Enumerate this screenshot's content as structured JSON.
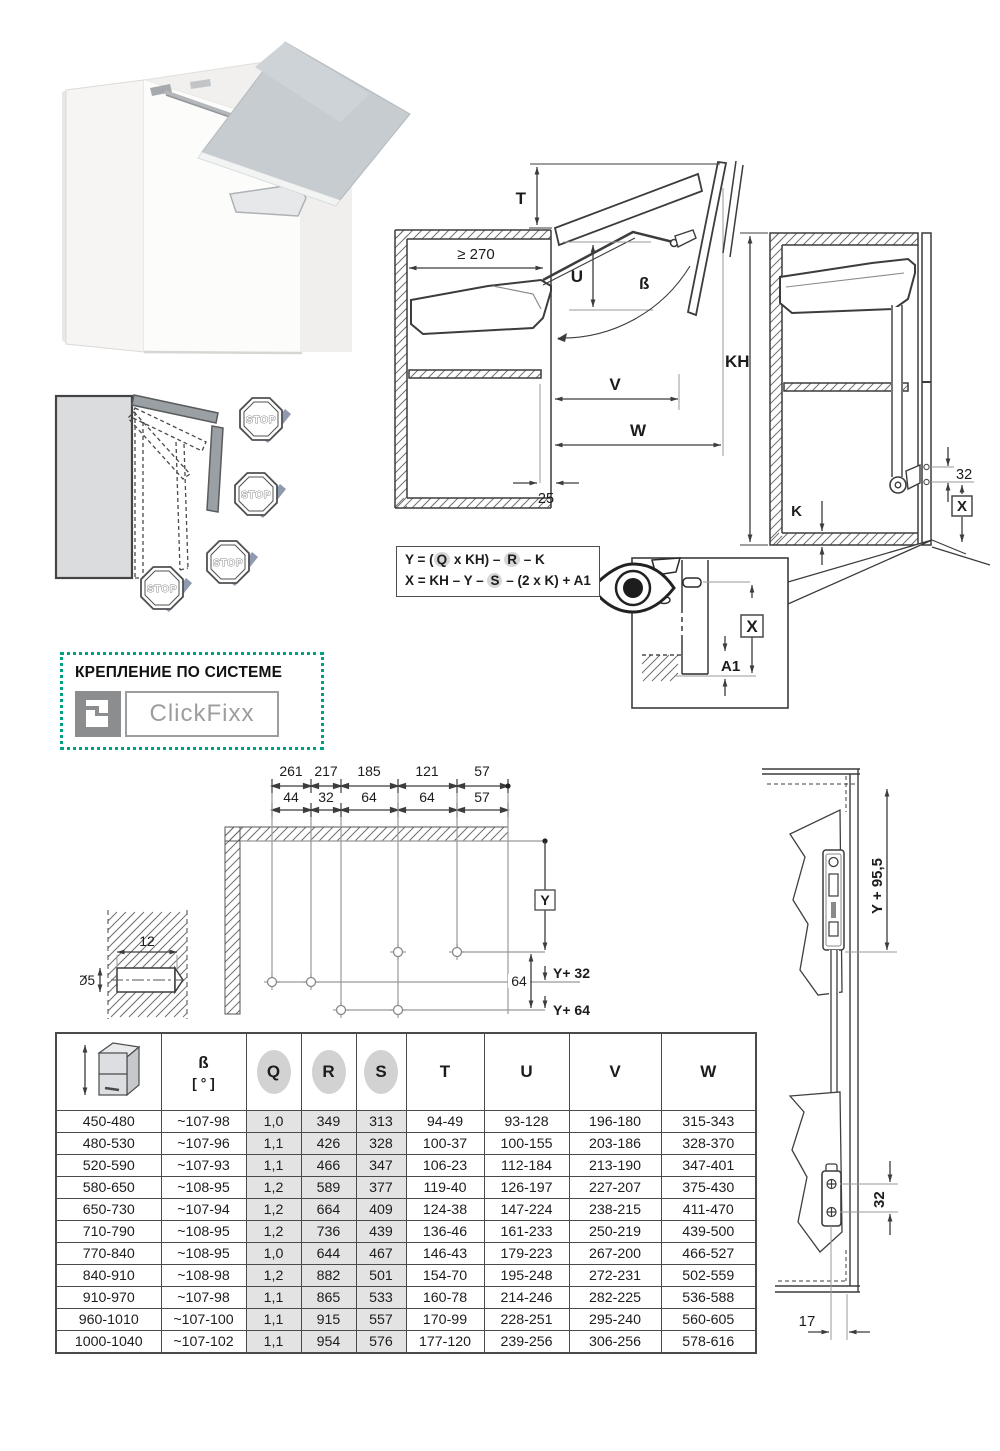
{
  "photo": {
    "name": "wall-cabinet-with-lifted-door"
  },
  "stop_diagram": {
    "stop": "STOP"
  },
  "section": {
    "t": "T",
    "min_depth": "≥ 270",
    "u": "U",
    "beta": "ß",
    "v": "V",
    "w": "W",
    "d25": "25"
  },
  "closed": {
    "kh": "KH",
    "k": "K",
    "x": "X",
    "d32": "32"
  },
  "formulas": {
    "y_pre": "Y = (",
    "y_q": "Q",
    "y_mid": " x KH) – ",
    "y_r": "R",
    "y_post": " – K",
    "x_pre": "X = KH – Y – ",
    "x_s": "S",
    "x_post": " – (2 x K) + A1"
  },
  "detail": {
    "x": "X",
    "a1": "A1"
  },
  "mounting": {
    "title": "КРЕПЛЕНИЕ ПО СИСТЕМЕ",
    "brand": "ClickFixx"
  },
  "drilling": {
    "row1": [
      "261",
      "217",
      "185",
      "121",
      "57"
    ],
    "row2": [
      "44",
      "32",
      "64",
      "64",
      "57"
    ],
    "y": "Y",
    "y32": "Y+ 32",
    "y64": "Y+ 64",
    "d64": "64",
    "d12": "12",
    "dia": "Ø5"
  },
  "side": {
    "y955": "Y + 95,5",
    "d32": "32",
    "d17": "17"
  },
  "table": {
    "headers": {
      "beta": "ß",
      "beta_unit": "[ ° ]",
      "q": "Q",
      "r": "R",
      "s": "S",
      "t": "T",
      "u": "U",
      "v": "V",
      "w": "W"
    },
    "rows": [
      [
        "450-480",
        "~107-98",
        "1,0",
        "349",
        "313",
        "94-49",
        "93-128",
        "196-180",
        "315-343"
      ],
      [
        "480-530",
        "~107-96",
        "1,1",
        "426",
        "328",
        "100-37",
        "100-155",
        "203-186",
        "328-370"
      ],
      [
        "520-590",
        "~107-93",
        "1,1",
        "466",
        "347",
        "106-23",
        "112-184",
        "213-190",
        "347-401"
      ],
      [
        "580-650",
        "~108-95",
        "1,2",
        "589",
        "377",
        "119-40",
        "126-197",
        "227-207",
        "375-430"
      ],
      [
        "650-730",
        "~107-94",
        "1,2",
        "664",
        "409",
        "124-38",
        "147-224",
        "238-215",
        "411-470"
      ],
      [
        "710-790",
        "~108-95",
        "1,2",
        "736",
        "439",
        "136-46",
        "161-233",
        "250-219",
        "439-500"
      ],
      [
        "770-840",
        "~108-95",
        "1,0",
        "644",
        "467",
        "146-43",
        "179-223",
        "267-200",
        "466-527"
      ],
      [
        "840-910",
        "~108-98",
        "1,2",
        "882",
        "501",
        "154-70",
        "195-248",
        "272-231",
        "502-559"
      ],
      [
        "910-970",
        "~107-98",
        "1,1",
        "865",
        "533",
        "160-78",
        "214-246",
        "282-225",
        "536-588"
      ],
      [
        "960-1010",
        "~107-100",
        "1,1",
        "915",
        "557",
        "170-99",
        "228-251",
        "295-240",
        "560-605"
      ],
      [
        "1000-1040",
        "~107-102",
        "1,1",
        "954",
        "576",
        "177-120",
        "239-256",
        "306-256",
        "578-616"
      ]
    ]
  },
  "colors": {
    "accent_teal": "#00a183",
    "line_dark": "#3f3f3f",
    "dim_gray": "#999999",
    "shade_gray": "#e3e3e3",
    "check_gray_blue": "#8f99af"
  }
}
